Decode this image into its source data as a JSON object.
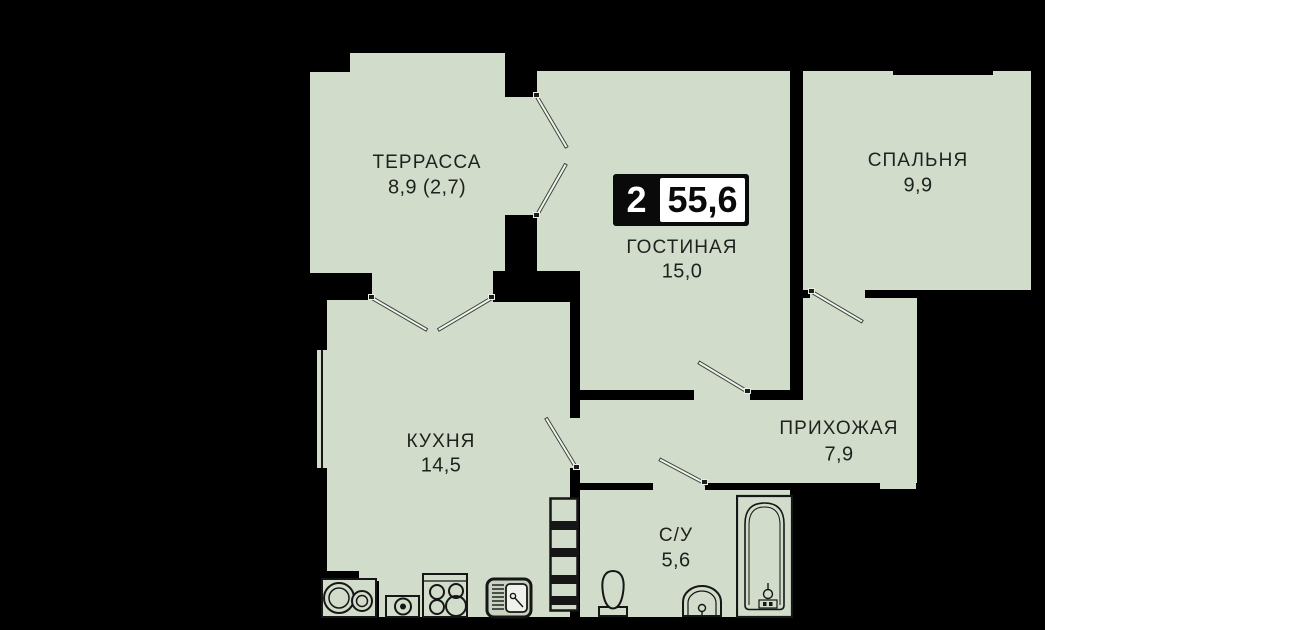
{
  "badge": {
    "room_count": "2",
    "total_area": "55,6"
  },
  "rooms": {
    "terrace": {
      "label": "ТЕРРАССА",
      "area": "8,9 (2,7)"
    },
    "living": {
      "label": "ГОСТИНАЯ",
      "area": "15,0"
    },
    "bedroom": {
      "label": "СПАЛЬНЯ",
      "area": "9,9"
    },
    "kitchen": {
      "label": "КУХНЯ",
      "area": "14,5"
    },
    "hallway": {
      "label": "ПРИХОЖАЯ",
      "area": "7,9"
    },
    "bathroom": {
      "label": "С/У",
      "area": "5,6"
    }
  },
  "colors": {
    "background": "#000000",
    "room_fill": "#d1dccb",
    "wall": "#000000",
    "text": "#1f211e",
    "badge_bg": "#0a0a0a",
    "badge_area_bg": "#ffffff",
    "door_leaf": "#f0f4ec",
    "page_margin": "#ffffff"
  },
  "fixtures": [
    "washing-machine",
    "dishwasher",
    "stove",
    "kitchen-sink",
    "shaft-ladder",
    "toilet",
    "washbasin",
    "bathtub"
  ]
}
